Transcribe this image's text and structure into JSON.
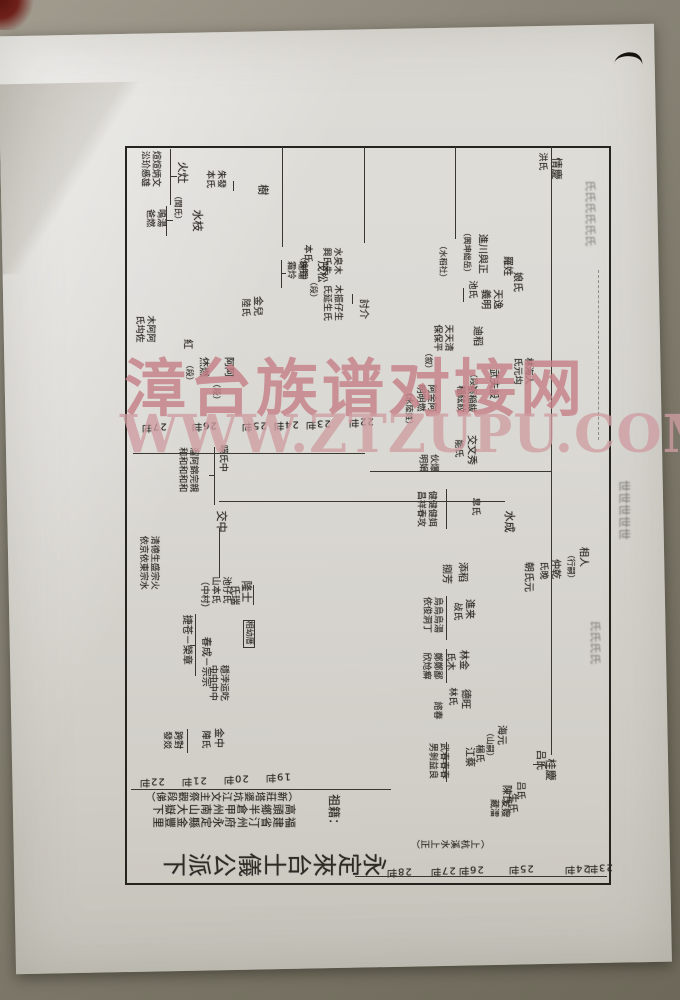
{
  "watermark": {
    "line1": "漳台族谱对接网",
    "line2": "WWW.ZTZUPU.COM",
    "color": "#c48088"
  },
  "chart": {
    "title": {
      "t": "永定來台士儀公派下",
      "x": 150,
      "y": 844,
      "fs": 24
    },
    "origin_label": {
      "t": "祖籍：",
      "x": 326,
      "y": 794,
      "fs": 12
    },
    "origin_lines": [
      {
        "t": "（新莊塔婆坑江文主祭觀段俤）",
        "x": 143,
        "y": 787,
        "fs": 10
      },
      {
        "t": "高頭鄉半倉甲州南山大嶽下",
        "x": 150,
        "y": 800,
        "fs": 11
      },
      {
        "t": "福建省汀州府永定縣金豐里",
        "x": 150,
        "y": 813,
        "fs": 11
      },
      {
        "t": "（上杭溪水上正）",
        "x": 408,
        "y": 835,
        "fs": 9
      }
    ],
    "boxed_label": {
      "t": "相幼厝",
      "x": 243,
      "y": 620,
      "fs": 8
    },
    "generation_labels": [
      {
        "t": "22世",
        "x": 337,
        "y": 414
      },
      {
        "t": "23世",
        "x": 294,
        "y": 416
      },
      {
        "t": "24世",
        "x": 262,
        "y": 417
      },
      {
        "t": "25世",
        "x": 230,
        "y": 418
      },
      {
        "t": "26世",
        "x": 180,
        "y": 418
      },
      {
        "t": "27世",
        "x": 130,
        "y": 419
      },
      {
        "t": "19世",
        "x": 254,
        "y": 769
      },
      {
        "t": "20世",
        "x": 212,
        "y": 771
      },
      {
        "t": "21世",
        "x": 170,
        "y": 773
      },
      {
        "t": "22世",
        "x": 128,
        "y": 774
      },
      {
        "t": "23世",
        "x": 576,
        "y": 860
      },
      {
        "t": "24世",
        "x": 553,
        "y": 861
      },
      {
        "t": "25世",
        "x": 497,
        "y": 861
      },
      {
        "t": "26世",
        "x": 447,
        "y": 862
      },
      {
        "t": "27世",
        "x": 419,
        "y": 863
      },
      {
        "t": "28世",
        "x": 375,
        "y": 864
      }
    ],
    "texts": [
      {
        "t": "煊煊炳文\n㳂玠㥻雄",
        "x": 138,
        "y": 151,
        "fs": 9
      },
      {
        "t": "火灶",
        "x": 175,
        "y": 162,
        "fs": 11
      },
      {
        "t": "（閩氏）",
        "x": 172,
        "y": 192,
        "fs": 8
      },
      {
        "t": "水枝",
        "x": 190,
        "y": 210,
        "fs": 11
      },
      {
        "t": "鳴湯\n爸燃",
        "x": 143,
        "y": 209,
        "fs": 9
      },
      {
        "t": "朱發\n本氏",
        "x": 203,
        "y": 170,
        "fs": 9
      },
      {
        "t": "樹",
        "x": 256,
        "y": 184,
        "fs": 11
      },
      {
        "t": "茂松",
        "x": 315,
        "y": 261,
        "fs": 11
      },
      {
        "t": "（煥明）",
        "x": 298,
        "y": 253,
        "fs": 8
      },
      {
        "t": "本氏",
        "x": 301,
        "y": 244,
        "fs": 9
      },
      {
        "t": "水㚖木\n興氏朱",
        "x": 320,
        "y": 247,
        "fs": 9
      },
      {
        "t": "（段）",
        "x": 308,
        "y": 278,
        "fs": 8
      },
      {
        "t": "瑞瑞\n霜炩",
        "x": 284,
        "y": 261,
        "fs": 9
      },
      {
        "t": "金兒",
        "x": 250,
        "y": 296,
        "fs": 10
      },
      {
        "t": "陸氏",
        "x": 239,
        "y": 298,
        "fs": 9
      },
      {
        "t": "木振仔生\n氏延生氏",
        "x": 320,
        "y": 285,
        "fs": 9
      },
      {
        "t": "討介",
        "x": 356,
        "y": 299,
        "fs": 10
      },
      {
        "t": "木阿阿\n氏㘬佐",
        "x": 133,
        "y": 315,
        "fs": 9
      },
      {
        "t": "紅",
        "x": 180,
        "y": 339,
        "fs": 10
      },
      {
        "t": "烋燃",
        "x": 196,
        "y": 357,
        "fs": 10
      },
      {
        "t": "（段）",
        "x": 184,
        "y": 361,
        "fs": 8
      },
      {
        "t": "阿阿",
        "x": 221,
        "y": 357,
        "fs": 10
      },
      {
        "t": "（段）",
        "x": 211,
        "y": 380,
        "fs": 8
      },
      {
        "t": "暎氏中",
        "x": 216,
        "y": 445,
        "fs": 9
      },
      {
        "t": "溜阿錦完親\n和和和和和",
        "x": 176,
        "y": 447,
        "fs": 9
      },
      {
        "t": "交中",
        "x": 214,
        "y": 511,
        "fs": 11
      },
      {
        "t": "池仔氏\n山本氏\n（中村）",
        "x": 197,
        "y": 577,
        "fs": 9
      },
      {
        "t": "隆士",
        "x": 239,
        "y": 581,
        "fs": 11
      },
      {
        "t": "氏瑞",
        "x": 227,
        "y": 585,
        "fs": 10
      },
      {
        "t": "清德生盛宗火\n依京依東宗水",
        "x": 136,
        "y": 536,
        "fs": 9
      },
      {
        "t": "捷苍－榮章",
        "x": 179,
        "y": 615,
        "fs": 10
      },
      {
        "t": "春成－宗宗",
        "x": 198,
        "y": 637,
        "fs": 10
      },
      {
        "t": "穩浡运吃\n中中中中",
        "x": 206,
        "y": 665,
        "fs": 9
      },
      {
        "t": "金中",
        "x": 211,
        "y": 728,
        "fs": 10
      },
      {
        "t": "陣氏",
        "x": 199,
        "y": 730,
        "fs": 9
      },
      {
        "t": "跨對\n發㸚",
        "x": 160,
        "y": 731,
        "fs": 9
      },
      {
        "t": "羅姓",
        "x": 500,
        "y": 256,
        "fs": 10
      },
      {
        "t": "娘氏",
        "x": 510,
        "y": 272,
        "fs": 10
      },
      {
        "t": "進川與正",
        "x": 475,
        "y": 234,
        "fs": 10
      },
      {
        "t": "（興坤絀岳）",
        "x": 461,
        "y": 229,
        "fs": 8
      },
      {
        "t": "（水稻社）",
        "x": 437,
        "y": 242,
        "fs": 8
      },
      {
        "t": "天逸\n義明",
        "x": 478,
        "y": 289,
        "fs": 10
      },
      {
        "t": "池氏",
        "x": 466,
        "y": 280,
        "fs": 9
      },
      {
        "t": "情慶",
        "x": 549,
        "y": 158,
        "fs": 11
      },
      {
        "t": "洪氏",
        "x": 536,
        "y": 152,
        "fs": 9
      },
      {
        "t": "林海人\n氏元㘬",
        "x": 511,
        "y": 357,
        "fs": 9
      },
      {
        "t": "武夫設",
        "x": 486,
        "y": 369,
        "fs": 10
      },
      {
        "t": "（段）",
        "x": 468,
        "y": 370,
        "fs": 8
      },
      {
        "t": "迪稻",
        "x": 470,
        "y": 326,
        "fs": 10
      },
      {
        "t": "天天清\n保保平",
        "x": 431,
        "y": 324,
        "fs": 9
      },
      {
        "t": "（叙）",
        "x": 423,
        "y": 349,
        "fs": 8
      },
      {
        "t": "張稲紱\n稲絃紋",
        "x": 454,
        "y": 385,
        "fs": 9
      },
      {
        "t": "阿金阿\n明明燃",
        "x": 414,
        "y": 384,
        "fs": 9
      },
      {
        "t": "（水陸姓）",
        "x": 403,
        "y": 389,
        "fs": 8
      },
      {
        "t": "交文秀",
        "x": 464,
        "y": 435,
        "fs": 10
      },
      {
        "t": "能氏",
        "x": 452,
        "y": 439,
        "fs": 9
      },
      {
        "t": "伙爆\n明娟",
        "x": 416,
        "y": 454,
        "fs": 9
      },
      {
        "t": "健健健㛅\n昌祥春攻",
        "x": 414,
        "y": 491,
        "fs": 9
      },
      {
        "t": "皐氏",
        "x": 469,
        "y": 497,
        "fs": 9
      },
      {
        "t": "水成",
        "x": 502,
        "y": 511,
        "fs": 11
      },
      {
        "t": "相人",
        "x": 576,
        "y": 547,
        "fs": 10
      },
      {
        "t": "（行嗣）",
        "x": 565,
        "y": 551,
        "fs": 8
      },
      {
        "t": "仲乾",
        "x": 548,
        "y": 559,
        "fs": 10
      },
      {
        "t": "氏晚",
        "x": 537,
        "y": 561,
        "fs": 9
      },
      {
        "t": "朝氏元",
        "x": 521,
        "y": 562,
        "fs": 10
      },
      {
        "t": "添稻",
        "x": 455,
        "y": 562,
        "fs": 10
      },
      {
        "t": "捌芳",
        "x": 439,
        "y": 564,
        "fs": 10
      },
      {
        "t": "進来",
        "x": 462,
        "y": 599,
        "fs": 10
      },
      {
        "t": "敁氏",
        "x": 451,
        "y": 602,
        "fs": 9
      },
      {
        "t": "烏烏烏湯\n依俊洞丁",
        "x": 420,
        "y": 597,
        "fs": 9
      },
      {
        "t": "林金",
        "x": 456,
        "y": 650,
        "fs": 10
      },
      {
        "t": "氏木",
        "x": 444,
        "y": 652,
        "fs": 9
      },
      {
        "t": "鄭鄭鄙\n欣炝癣",
        "x": 420,
        "y": 652,
        "fs": 9
      },
      {
        "t": "德旺",
        "x": 458,
        "y": 689,
        "fs": 10
      },
      {
        "t": "林氏",
        "x": 446,
        "y": 687,
        "fs": 9
      },
      {
        "t": "諮春",
        "x": 431,
        "y": 701,
        "fs": 9
      },
      {
        "t": "海元",
        "x": 494,
        "y": 725,
        "fs": 10
      },
      {
        "t": "（山嗣）",
        "x": 484,
        "y": 729,
        "fs": 8
      },
      {
        "t": "楊氏",
        "x": 473,
        "y": 744,
        "fs": 9
      },
      {
        "t": "江蔡",
        "x": 462,
        "y": 747,
        "fs": 10
      },
      {
        "t": "武春春春\n男剝益良",
        "x": 426,
        "y": 743,
        "fs": 9
      },
      {
        "t": "吕氏",
        "x": 533,
        "y": 750,
        "fs": 10
      },
      {
        "t": "桂慶",
        "x": 543,
        "y": 759,
        "fs": 11
      },
      {
        "t": "陳氏",
        "x": 499,
        "y": 785,
        "fs": 10
      },
      {
        "t": "吕氏",
        "x": 514,
        "y": 781,
        "fs": 9
      },
      {
        "t": "生氏",
        "x": 505,
        "y": 793,
        "fs": 10
      },
      {
        "t": "友嫂\n藏㵢",
        "x": 487,
        "y": 799,
        "fs": 9
      }
    ],
    "connectors": [
      {
        "x": 551,
        "y": 147,
        "w": 1,
        "h": 608
      },
      {
        "x": 282,
        "y": 147,
        "w": 1,
        "h": 100
      },
      {
        "x": 364,
        "y": 147,
        "w": 1,
        "h": 96
      },
      {
        "x": 455,
        "y": 147,
        "w": 1,
        "h": 92
      },
      {
        "x": 133,
        "y": 453,
        "w": 232,
        "h": 1
      },
      {
        "x": 370,
        "y": 471,
        "w": 181,
        "h": 1
      },
      {
        "x": 219,
        "y": 501,
        "w": 286,
        "h": 1
      },
      {
        "x": 131,
        "y": 789,
        "w": 260,
        "h": 1
      },
      {
        "x": 355,
        "y": 876,
        "w": 252,
        "h": 1
      },
      {
        "x": 170,
        "y": 149,
        "w": 1,
        "h": 56
      },
      {
        "x": 171,
        "y": 176,
        "w": 6,
        "h": 1
      },
      {
        "x": 166,
        "y": 206,
        "w": 1,
        "h": 30
      },
      {
        "x": 167,
        "y": 220,
        "w": 6,
        "h": 1
      },
      {
        "x": 233,
        "y": 181,
        "w": 1,
        "h": 10
      },
      {
        "x": 281,
        "y": 260,
        "w": 1,
        "h": 28
      },
      {
        "x": 282,
        "y": 273,
        "w": 4,
        "h": 1
      },
      {
        "x": 352,
        "y": 294,
        "w": 1,
        "h": 10
      },
      {
        "x": 214,
        "y": 447,
        "w": 1,
        "h": 58
      },
      {
        "x": 209,
        "y": 475,
        "w": 6,
        "h": 1
      },
      {
        "x": 219,
        "y": 528,
        "w": 1,
        "h": 50
      },
      {
        "x": 253,
        "y": 585,
        "w": 1,
        "h": 20
      },
      {
        "x": 195,
        "y": 614,
        "w": 1,
        "h": 62
      },
      {
        "x": 190,
        "y": 645,
        "w": 6,
        "h": 1
      },
      {
        "x": 187,
        "y": 729,
        "w": 1,
        "h": 24
      },
      {
        "x": 446,
        "y": 489,
        "w": 1,
        "h": 40
      },
      {
        "x": 446,
        "y": 596,
        "w": 1,
        "h": 44
      },
      {
        "x": 446,
        "y": 649,
        "w": 1,
        "h": 34
      },
      {
        "x": 446,
        "y": 742,
        "w": 1,
        "h": 40
      },
      {
        "x": 463,
        "y": 288,
        "w": 1,
        "h": 14
      },
      {
        "x": 533,
        "y": 764,
        "w": 11,
        "h": 1
      },
      {
        "x": 598,
        "y": 270,
        "w": 1,
        "h": 170,
        "dash": true
      }
    ],
    "border": {
      "x": 125,
      "y": 146,
      "w": 482,
      "h": 735
    }
  },
  "ghosts": [
    {
      "t": "氏氏氏氏氏氏",
      "x": 583,
      "y": 180,
      "fs": 11
    },
    {
      "t": "世世世世世",
      "x": 616,
      "y": 480,
      "fs": 12
    },
    {
      "t": "氏氏氏氏",
      "x": 588,
      "y": 620,
      "fs": 11
    }
  ]
}
